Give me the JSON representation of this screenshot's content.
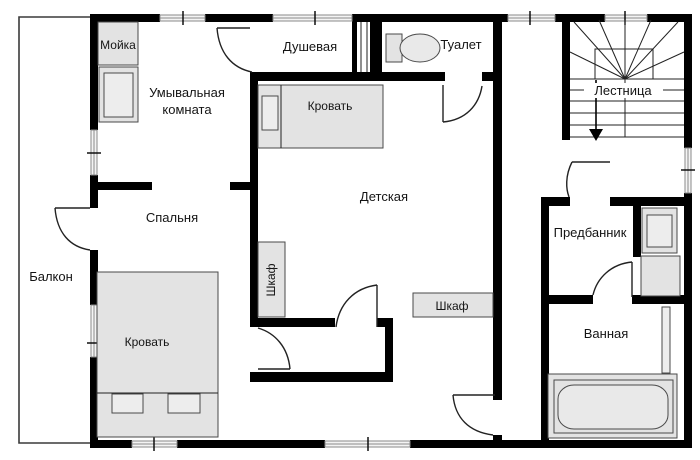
{
  "colors": {
    "wall": "#000000",
    "furn": "#e3e3e3",
    "stroke": "#4a4a4a"
  },
  "labels": {
    "washroom1": "Умывальная",
    "washroom2": "комната",
    "shower": "Душевая",
    "toilet": "Туалет",
    "stairs": "Лестница",
    "bedroom": "Спальня",
    "nursery": "Детская",
    "anteroom": "Предбанник",
    "bathroom": "Ванная",
    "balcony": "Балкон",
    "sink": "Мойка",
    "bed_nursery": "Кровать",
    "bed_bedroom": "Кровать",
    "closet_left": "Шкаф",
    "closet_bottom": "Шкаф"
  }
}
